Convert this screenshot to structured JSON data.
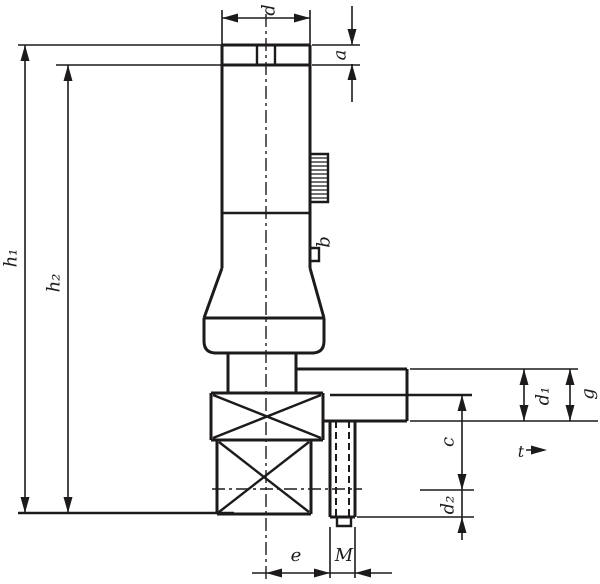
{
  "drawing": {
    "background": "#ffffff",
    "line_color": "#1d1a1b",
    "dimensions": {
      "top_diameter": "d",
      "cap_height": "a",
      "height_outer": "h₁",
      "height_inner": "h₂",
      "mid_detail": "b",
      "outlet_diameter": "d₁",
      "thread_length": "g",
      "center_to_tip": "c",
      "tip_diameter": "d₂",
      "offset": "e",
      "nozzle_thread": "M",
      "depth": "t"
    }
  }
}
